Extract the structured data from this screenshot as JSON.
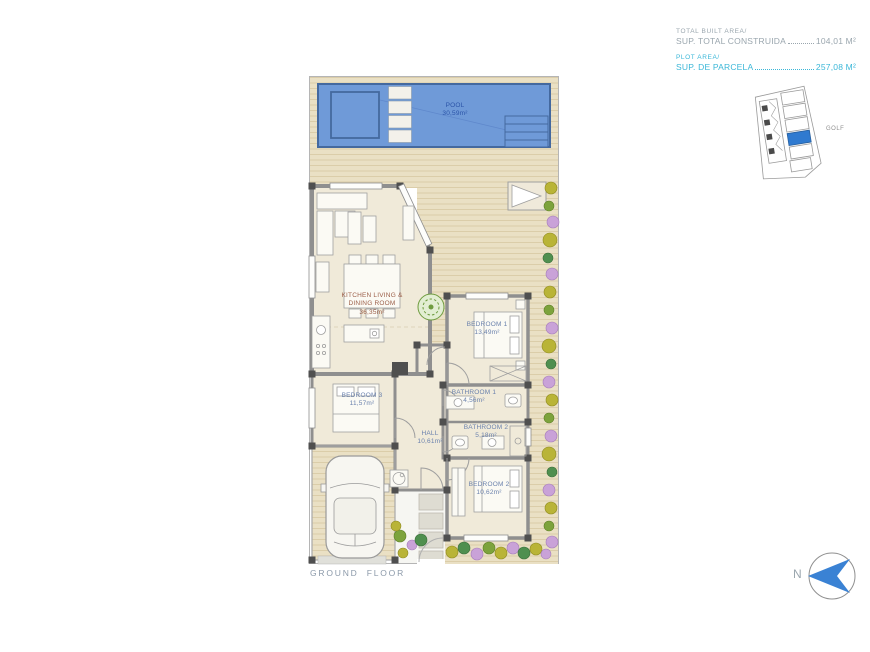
{
  "info_panel": {
    "built_label": "TOTAL BUILT AREA/",
    "built_name": "SUP. TOTAL CONSTRUIDA",
    "built_value": "104,01 M²",
    "plot_label": "PLOT AREA/",
    "plot_name": "SUP. DE PARCELA",
    "plot_value": "257,08 M²"
  },
  "site_map": {
    "context_label": "GOLF",
    "highlight_color": "#2f7ad0"
  },
  "compass": {
    "north_label": "N",
    "arrow_color": "#3a82d4"
  },
  "floor_plan": {
    "title": "GROUND FLOOR",
    "rooms": {
      "pool": {
        "name": "POOL",
        "area": "30,59m²"
      },
      "kitchen_living": {
        "name": "KITCHEN LIVING & DINING ROOM",
        "area": "36,35m²"
      },
      "bedroom1": {
        "name": "BEDROOM 1",
        "area": "13,49m²"
      },
      "bedroom2": {
        "name": "BEDROOM 2",
        "area": "10,62m²"
      },
      "bedroom3": {
        "name": "BEDROOM 3",
        "area": "11,57m²"
      },
      "bathroom1": {
        "name": "BATHROOM 1",
        "area": "4,56m²"
      },
      "bathroom2": {
        "name": "BATHROOM 2",
        "area": "5,18m²"
      },
      "hall": {
        "name": "HALL",
        "area": "10,61m²"
      }
    }
  },
  "colors": {
    "pool_water": "#6f9ad8",
    "pool_edge": "#44699f",
    "wood_deck": "#eae0c4",
    "interior_floor": "#f0ead9",
    "wall": "#8f8f8f",
    "accent_cyan": "#3bb7d8",
    "label_blue": "#6b82ad",
    "label_red": "#9c5f49"
  }
}
